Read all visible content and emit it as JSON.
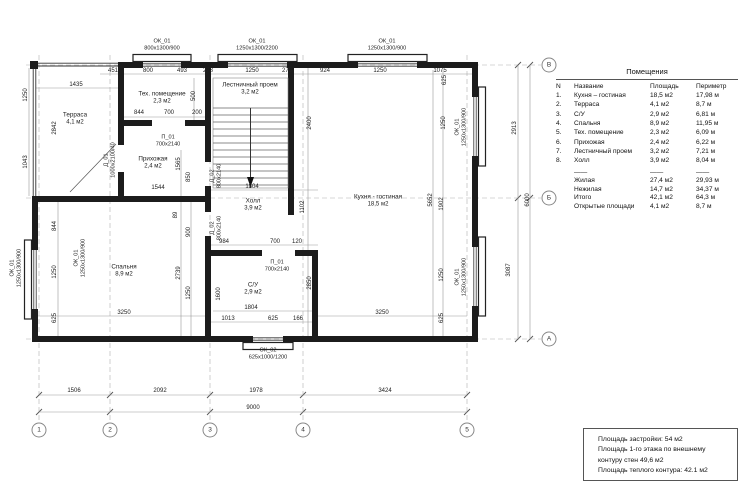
{
  "drawing": {
    "rooms": [
      {
        "name": "Терраса",
        "area": "4,1 м2",
        "x": 75,
        "y": 119
      },
      {
        "name": "Тех. помещение",
        "area": "2,3 м2",
        "x": 162,
        "y": 98
      },
      {
        "name": "Лестничный проем",
        "area": "3,2 м2",
        "x": 250,
        "y": 89
      },
      {
        "name": "Прихожая",
        "area": "2,4 м2",
        "x": 153,
        "y": 163
      },
      {
        "name": "Холл",
        "area": "3,9 м2",
        "x": 253,
        "y": 205
      },
      {
        "name": "Спальня",
        "area": "8,9 м2",
        "x": 124,
        "y": 271
      },
      {
        "name": "С/У",
        "area": "2,9 м2",
        "x": 253,
        "y": 289
      },
      {
        "name": "Кухня - гостиная",
        "area": "18,5 м2",
        "x": 378,
        "y": 201
      }
    ],
    "openings": [
      {
        "code": "ОК_01",
        "size": "800х1300/900",
        "x": 162,
        "y": 45,
        "v": 0
      },
      {
        "code": "ОК_01",
        "size": "1250х1300/2200",
        "x": 257,
        "y": 45,
        "v": 0
      },
      {
        "code": "ОК_01",
        "size": "1250х1300/900",
        "x": 387,
        "y": 45,
        "v": 0
      },
      {
        "code": "ОК_01",
        "size": "1250х1300/900",
        "x": 16,
        "y": 268,
        "v": 1
      },
      {
        "code": "ОК_01",
        "size": "1250х1300/900",
        "x": 80,
        "y": 258,
        "v": 1
      },
      {
        "code": "ОК_01",
        "size": "1250х1300/900",
        "x": 461,
        "y": 127,
        "v": 1
      },
      {
        "code": "ОК_01",
        "size": "1250х1300/900",
        "x": 461,
        "y": 277,
        "v": 1
      },
      {
        "code": "ОК_02",
        "size": "625х1000/1200",
        "x": 268,
        "y": 354,
        "v": 0
      },
      {
        "code": "Д_01",
        "size": "1000х2100/40",
        "x": 110,
        "y": 160,
        "v": 1
      },
      {
        "code": "Д_02",
        "size": "800х2140",
        "x": 216,
        "y": 176,
        "v": 1
      },
      {
        "code": "Д_02",
        "size": "800х2140",
        "x": 216,
        "y": 228,
        "v": 1
      },
      {
        "code": "П_01",
        "size": "700х2140",
        "x": 168,
        "y": 141,
        "v": 0
      },
      {
        "code": "П_01",
        "size": "700х2140",
        "x": 277,
        "y": 266,
        "v": 0
      }
    ],
    "dims": [
      {
        "t": "1435",
        "x": 76,
        "y": 85,
        "v": 0
      },
      {
        "t": "451",
        "x": 113,
        "y": 71,
        "v": 0
      },
      {
        "t": "800",
        "x": 148,
        "y": 71,
        "v": 0
      },
      {
        "t": "493",
        "x": 182,
        "y": 71,
        "v": 0
      },
      {
        "t": "278",
        "x": 208,
        "y": 71,
        "v": 0
      },
      {
        "t": "1250",
        "x": 252,
        "y": 71,
        "v": 0
      },
      {
        "t": "278",
        "x": 287,
        "y": 71,
        "v": 0
      },
      {
        "t": "924",
        "x": 325,
        "y": 71,
        "v": 0
      },
      {
        "t": "1250",
        "x": 380,
        "y": 71,
        "v": 0
      },
      {
        "t": "1075",
        "x": 440,
        "y": 71,
        "v": 0
      },
      {
        "t": "844",
        "x": 139,
        "y": 113,
        "v": 0
      },
      {
        "t": "700",
        "x": 169,
        "y": 113,
        "v": 0
      },
      {
        "t": "200",
        "x": 197,
        "y": 113,
        "v": 0
      },
      {
        "t": "500",
        "x": 194,
        "y": 96,
        "v": 1
      },
      {
        "t": "1250",
        "x": 26,
        "y": 95,
        "v": 1
      },
      {
        "t": "1043",
        "x": 26,
        "y": 162,
        "v": 1
      },
      {
        "t": "2842",
        "x": 55,
        "y": 128,
        "v": 1
      },
      {
        "t": "844",
        "x": 55,
        "y": 226,
        "v": 1
      },
      {
        "t": "1250",
        "x": 55,
        "y": 272,
        "v": 1
      },
      {
        "t": "625",
        "x": 55,
        "y": 318,
        "v": 1
      },
      {
        "t": "1544",
        "x": 158,
        "y": 188,
        "v": 0
      },
      {
        "t": "1565",
        "x": 179,
        "y": 164,
        "v": 1
      },
      {
        "t": "850",
        "x": 189,
        "y": 177,
        "v": 1
      },
      {
        "t": "89",
        "x": 176,
        "y": 215,
        "v": 1
      },
      {
        "t": "900",
        "x": 189,
        "y": 232,
        "v": 1
      },
      {
        "t": "2739",
        "x": 179,
        "y": 273,
        "v": 1
      },
      {
        "t": "1250",
        "x": 189,
        "y": 293,
        "v": 1
      },
      {
        "t": "3250",
        "x": 124,
        "y": 313,
        "v": 0
      },
      {
        "t": "2400",
        "x": 310,
        "y": 123,
        "v": 1
      },
      {
        "t": "1102",
        "x": 303,
        "y": 207,
        "v": 1
      },
      {
        "t": "1804",
        "x": 252,
        "y": 187,
        "v": 0
      },
      {
        "t": "984",
        "x": 224,
        "y": 242,
        "v": 0
      },
      {
        "t": "700",
        "x": 275,
        "y": 242,
        "v": 0
      },
      {
        "t": "120",
        "x": 297,
        "y": 242,
        "v": 0
      },
      {
        "t": "1600",
        "x": 219,
        "y": 294,
        "v": 1
      },
      {
        "t": "1804",
        "x": 251,
        "y": 308,
        "v": 0
      },
      {
        "t": "1013",
        "x": 228,
        "y": 319,
        "v": 0
      },
      {
        "t": "625",
        "x": 273,
        "y": 319,
        "v": 0
      },
      {
        "t": "166",
        "x": 298,
        "y": 319,
        "v": 0
      },
      {
        "t": "2850",
        "x": 310,
        "y": 283,
        "v": 1
      },
      {
        "t": "3250",
        "x": 382,
        "y": 313,
        "v": 0
      },
      {
        "t": "5652",
        "x": 431,
        "y": 200,
        "v": 1
      },
      {
        "t": "1902",
        "x": 442,
        "y": 204,
        "v": 1
      },
      {
        "t": "1250",
        "x": 442,
        "y": 275,
        "v": 1
      },
      {
        "t": "625",
        "x": 442,
        "y": 318,
        "v": 1
      },
      {
        "t": "625",
        "x": 445,
        "y": 80,
        "v": 1
      },
      {
        "t": "1250",
        "x": 444,
        "y": 123,
        "v": 1
      },
      {
        "t": "1506",
        "x": 74,
        "y": 391,
        "v": 0
      },
      {
        "t": "2092",
        "x": 160,
        "y": 391,
        "v": 0
      },
      {
        "t": "1978",
        "x": 256,
        "y": 391,
        "v": 0
      },
      {
        "t": "3424",
        "x": 385,
        "y": 391,
        "v": 0
      },
      {
        "t": "9000",
        "x": 253,
        "y": 408,
        "v": 0
      },
      {
        "t": "2913",
        "x": 515,
        "y": 128,
        "v": 1
      },
      {
        "t": "3087",
        "x": 509,
        "y": 270,
        "v": 1
      },
      {
        "t": "6000",
        "x": 528,
        "y": 200,
        "v": 1
      }
    ],
    "grid": {
      "cols": [
        {
          "label": "1",
          "x": 39
        },
        {
          "label": "2",
          "x": 110
        },
        {
          "label": "3",
          "x": 210
        },
        {
          "label": "4",
          "x": 303
        },
        {
          "label": "5",
          "x": 467
        }
      ],
      "rows": [
        {
          "label": "В",
          "y": 65
        },
        {
          "label": "Б",
          "y": 198
        },
        {
          "label": "А",
          "y": 339
        }
      ],
      "col_bubble_y": 430,
      "row_bubble_x": 549
    }
  },
  "table": {
    "title": "Помещения",
    "columns": [
      "N",
      "Название",
      "Площадь",
      "Периметр"
    ],
    "rows": [
      {
        "n": "1.",
        "name": "Кухня – гостиная",
        "area": "18,5 м2",
        "perimeter": "17,98 м"
      },
      {
        "n": "2.",
        "name": "Терраса",
        "area": "4,1 м2",
        "perimeter": "8,7 м"
      },
      {
        "n": "3.",
        "name": "С/У",
        "area": "2,9 м2",
        "perimeter": "6,81 м"
      },
      {
        "n": "4.",
        "name": "Спальня",
        "area": "8,9 м2",
        "perimeter": "11,95 м"
      },
      {
        "n": "5.",
        "name": "Тех. помещение",
        "area": "2,3 м2",
        "perimeter": "6,09 м"
      },
      {
        "n": "6.",
        "name": "Прихожая",
        "area": "2,4 м2",
        "perimeter": "6,22 м"
      },
      {
        "n": "7.",
        "name": "Лестничный проем",
        "area": "3,2 м2",
        "perimeter": "7,21 м"
      },
      {
        "n": "8.",
        "name": "Холл",
        "area": "3,9 м2",
        "perimeter": "8,04 м"
      }
    ],
    "separator": {
      "name": "——",
      "area": "——",
      "perimeter": "——"
    },
    "totals": [
      {
        "name": "Жилая",
        "area": "27,4 м2",
        "perimeter": "29,93 м"
      },
      {
        "name": "Нежилая",
        "area": "14,7 м2",
        "perimeter": "34,37 м"
      },
      {
        "name": "Итого",
        "area": "42,1 м2",
        "perimeter": "64,3 м"
      },
      {
        "name": "Открытые площади",
        "area": "4,1 м2",
        "perimeter": "8,7 м"
      }
    ]
  },
  "notes": {
    "lines": [
      "Площадь застройки: 54 м2",
      "Площадь 1-го этажа по внешнему",
      "контуру стен 49,6 м2",
      "Площадь теплого контура: 42.1 м2"
    ]
  }
}
